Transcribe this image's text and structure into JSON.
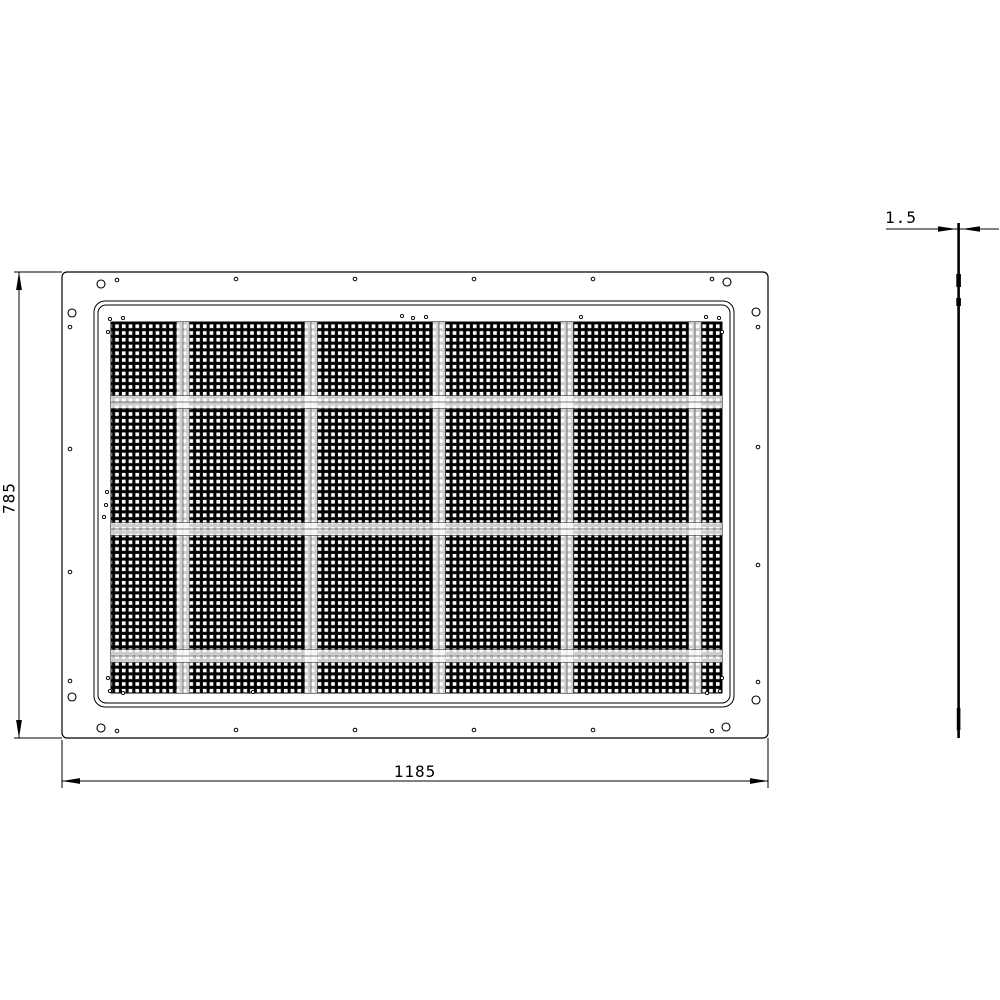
{
  "colors": {
    "ink": "#000000",
    "paper": "#ffffff"
  },
  "dimensions": {
    "height_label": "785",
    "width_label": "1185",
    "thickness_label": "1.5"
  },
  "front_view": {
    "outer_rect": {
      "x": 62,
      "y": 272,
      "w": 706,
      "h": 466,
      "r": 5
    },
    "frame_outer": {
      "x": 94,
      "y": 301,
      "w": 640,
      "h": 406,
      "r": 11
    },
    "frame_inner": {
      "x": 98,
      "y": 305,
      "w": 632,
      "h": 398,
      "r": 8
    },
    "mesh": {
      "x": 111,
      "y": 322,
      "w": 611,
      "h": 371,
      "pitch": 6.75,
      "band_size": 13,
      "bands_x": [
        183,
        311,
        439,
        567,
        695
      ],
      "bands_y": [
        402,
        529,
        656
      ]
    },
    "holes_large": [
      [
        101,
        284
      ],
      [
        727,
        282
      ],
      [
        101,
        728
      ],
      [
        726,
        727
      ],
      [
        72,
        313
      ],
      [
        756,
        312
      ],
      [
        72,
        697
      ],
      [
        756,
        700
      ]
    ],
    "holes_small": [
      [
        117,
        280
      ],
      [
        236,
        279
      ],
      [
        355,
        279
      ],
      [
        474,
        279
      ],
      [
        593,
        279
      ],
      [
        712,
        279
      ],
      [
        117,
        731
      ],
      [
        236,
        730
      ],
      [
        355,
        730
      ],
      [
        474,
        730
      ],
      [
        593,
        730
      ],
      [
        712,
        731
      ],
      [
        70,
        327
      ],
      [
        70,
        449
      ],
      [
        70,
        572
      ],
      [
        70,
        681
      ],
      [
        758,
        327
      ],
      [
        758,
        447
      ],
      [
        758,
        565
      ],
      [
        758,
        682
      ]
    ],
    "mesh_marks": [
      [
        110,
        319
      ],
      [
        123,
        318
      ],
      [
        108,
        332
      ],
      [
        402,
        316
      ],
      [
        413,
        318
      ],
      [
        426,
        317
      ],
      [
        581,
        317
      ],
      [
        706,
        317
      ],
      [
        719,
        318
      ],
      [
        722,
        332
      ],
      [
        107,
        492
      ],
      [
        106,
        505
      ],
      [
        104,
        517
      ],
      [
        108,
        678
      ],
      [
        110,
        691
      ],
      [
        123,
        693
      ],
      [
        253,
        692
      ],
      [
        722,
        678
      ],
      [
        720,
        691
      ],
      [
        707,
        693
      ]
    ]
  },
  "side_view": {
    "bar": {
      "x": 957.3,
      "y": 223,
      "w": 2.6,
      "h": 515
    },
    "lugs": [
      [
        956.3,
        274,
        4.6,
        13
      ],
      [
        956.3,
        298,
        4.6,
        8
      ],
      [
        956.8,
        708,
        3.6,
        22
      ]
    ]
  }
}
